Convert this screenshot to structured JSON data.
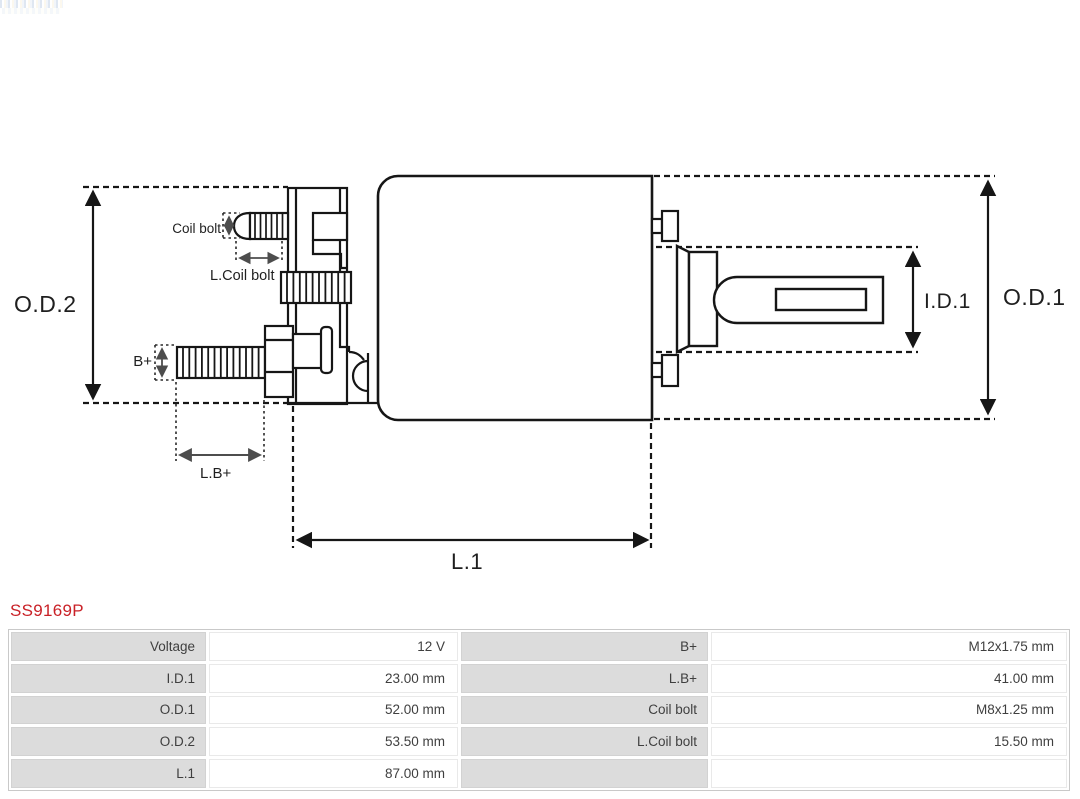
{
  "part_number": "SS9169P",
  "accent_color": "#c92127",
  "diagram": {
    "line_color": "#161616",
    "labels": {
      "od2": "O.D.2",
      "od1": "O.D.1",
      "id1": "I.D.1",
      "l1": "L.1",
      "coil_bolt": "Coil bolt",
      "l_coil_bolt": "L.Coil bolt",
      "b_plus": "B+",
      "l_b_plus": "L.B+"
    }
  },
  "spec_table": {
    "label_bg": "#dcdcdc",
    "value_bg": "#ffffff",
    "rows": [
      {
        "c0": "Voltage",
        "c1": "12 V",
        "c2": "B+",
        "c3": "M12x1.75 mm"
      },
      {
        "c0": "I.D.1",
        "c1": "23.00 mm",
        "c2": "L.B+",
        "c3": "41.00 mm"
      },
      {
        "c0": "O.D.1",
        "c1": "52.00 mm",
        "c2": "Coil bolt",
        "c3": "M8x1.25 mm"
      },
      {
        "c0": "O.D.2",
        "c1": "53.50 mm",
        "c2": "L.Coil bolt",
        "c3": "15.50 mm"
      },
      {
        "c0": "L.1",
        "c1": "87.00 mm",
        "c2": "",
        "c3": ""
      }
    ]
  }
}
